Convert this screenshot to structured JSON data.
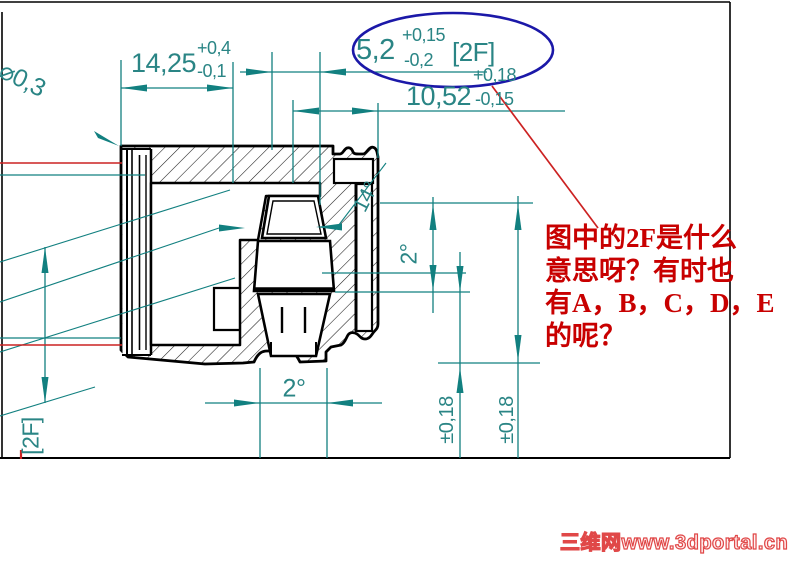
{
  "colors": {
    "dimension_teal": "#128080",
    "text_teal": "#2a8585",
    "highlight_blue": "#1b18a8",
    "annotation_red": "#c80000",
    "outline_black": "#000000",
    "watermark_pink_red": "#e04848"
  },
  "dims": {
    "d1425": {
      "value": "14,25",
      "tol_plus": "+0,4",
      "tol_minus": "-0,1"
    },
    "d52": {
      "value": "5,2",
      "tol_plus": "+0,15",
      "tol_minus": "-0,2",
      "flag": "[2F]"
    },
    "d1052": {
      "value": "10,52",
      "tol_plus": "+0,18",
      "tol_minus": "-0,15"
    },
    "r03": "⌀0,3",
    "angle_14": "14°",
    "angle_2_side": "2°",
    "angle_2_bottom": "2°",
    "tol_018_a": "±0,18",
    "tol_018_b": "±0,18",
    "flag_2f_left": "[2F]"
  },
  "annotation": {
    "lines": [
      "图中的2F是什么",
      "意思呀？有时也",
      "有A，B，C，D，E",
      "的呢？"
    ]
  },
  "watermark": "三维网www.3dportal.cn"
}
